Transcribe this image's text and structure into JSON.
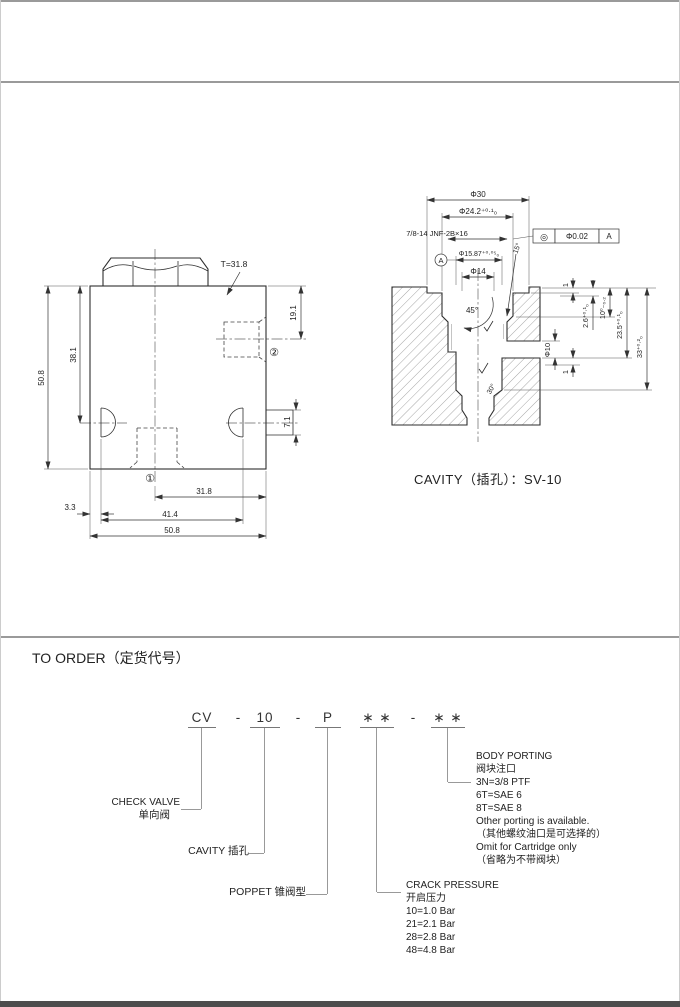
{
  "left_view": {
    "t_label": "T=31.8",
    "dim_height": "50.8",
    "dim_38_1": "38.1",
    "dim_19_1": "19.1",
    "dim_7_1": "7.1",
    "port_1": "①",
    "port_2": "②",
    "dim_31_8": "31.8",
    "dim_3_3": "3.3",
    "dim_41_4": "41.4",
    "dim_width": "50.8"
  },
  "cavity_view": {
    "caption": "CAVITY（插孔）：SV-10",
    "dim_d30": "Φ30",
    "dim_d24_2": "Φ24.2⁺⁰·¹₀",
    "thread": "7/8-14 JNF-2B×16",
    "fcf_symbol": "◎",
    "fcf_tolerance": "Φ0.02",
    "fcf_datum": "A",
    "datum_label": "A",
    "dim_d15_87": "Φ15.87⁺⁰·⁰⁵₀",
    "dim_d14": "Φ14",
    "angle_15": "15°",
    "angle_45": "45°",
    "angle_30": "30°",
    "dim_1_top": "1",
    "dim_2_6": "2.6⁺⁰·¹₀",
    "dim_10_depth": "10⁰₋₀.₂",
    "dim_23_5": "23.5⁺⁰·¹₀",
    "dim_33": "33⁺⁰·²₀",
    "dim_d10": "Φ10",
    "dim_1_bottom": "1"
  },
  "order": {
    "title": "TO ORDER（定货代号）",
    "code": [
      "CV",
      "-",
      "10",
      "-",
      "P",
      "∗ ∗",
      "-",
      "∗ ∗"
    ],
    "check_valve_en": "CHECK VALVE",
    "check_valve_zh": "单向阀",
    "cavity_label": "CAVITY 插孔",
    "poppet_label": "POPPET 锥阀型",
    "crack_pressure": {
      "en": "CRACK PRESSURE",
      "zh": "开启压力",
      "options": [
        "10=1.0 Bar",
        "21=2.1 Bar",
        "28=2.8 Bar",
        "48=4.8 Bar"
      ]
    },
    "body_porting": {
      "en": "BODY PORTING",
      "zh": "阀块注口",
      "options": [
        "3N=3/8  PTF",
        "6T=SAE  6",
        "8T=SAE  8"
      ],
      "notes": [
        "Other porting is available.",
        "（其他螺纹油口是可选择的）",
        "Omit for Cartridge only",
        "（省略为不带阀块）"
      ]
    }
  }
}
